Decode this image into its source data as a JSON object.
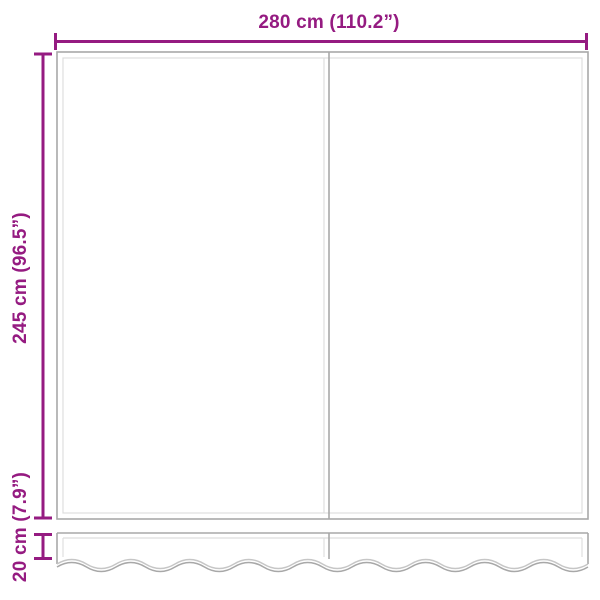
{
  "diagram": {
    "width_dimension": {
      "label": "280 cm (110.2”)"
    },
    "height_dimension": {
      "label": "245 cm (96.5”)"
    },
    "valance_dimension": {
      "label": "20 cm (7.9”)"
    }
  },
  "colors": {
    "accent": "#951B81",
    "line_dark": "#A8A8A8",
    "line_light": "#DEDEDE",
    "background": "#FFFFFF"
  }
}
